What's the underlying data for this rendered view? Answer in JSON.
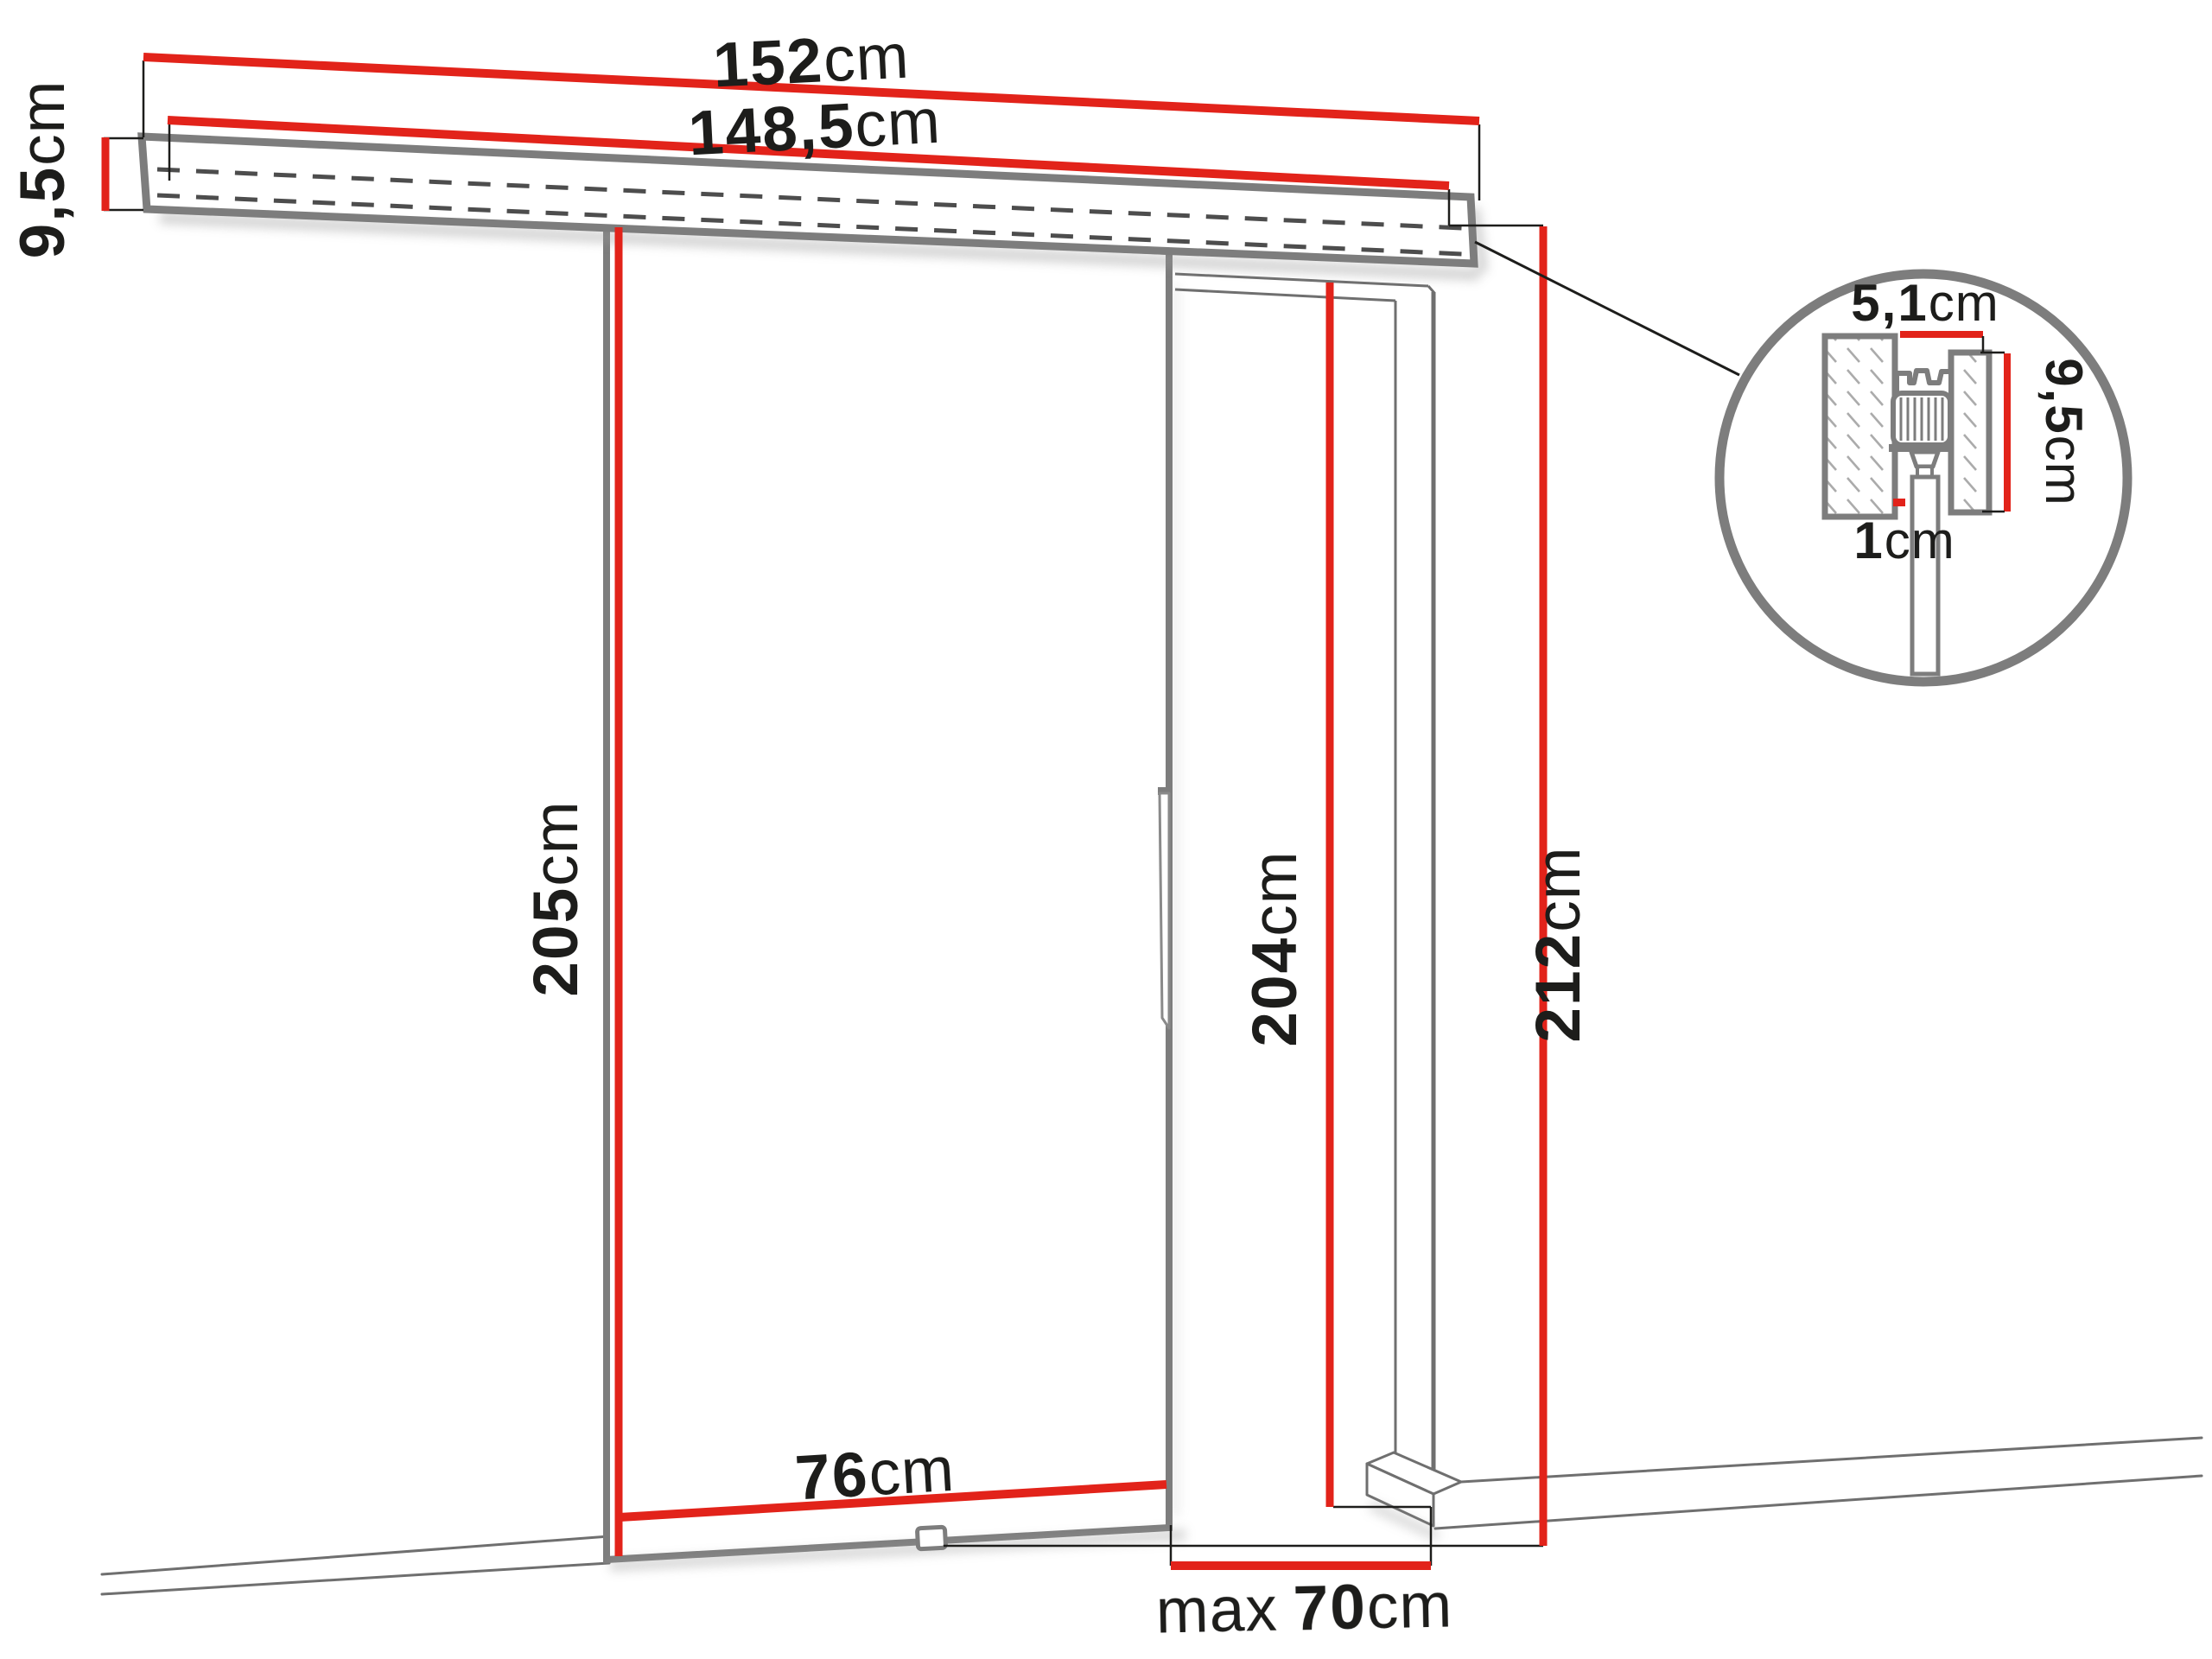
{
  "title": "Sliding door system dimension diagram",
  "colors": {
    "dimension_red": "#e2231a",
    "outline_gray": "#7d7d7d",
    "thin_line_gray": "#6f6f6f",
    "dash_gray": "#4d4d4d",
    "text_black": "#1d1d1b",
    "background": "#ffffff"
  },
  "labels": {
    "track_total": {
      "value": "152",
      "unit": "cm"
    },
    "track_effective": {
      "value": "148,5",
      "unit": "cm"
    },
    "track_height": {
      "value": "9,5",
      "unit": "cm"
    },
    "door_height": {
      "value": "205",
      "unit": "cm"
    },
    "opening_height": {
      "value": "204",
      "unit": "cm"
    },
    "overall_height": {
      "value": "212",
      "unit": "cm"
    },
    "door_width": {
      "value": "76",
      "unit": "cm"
    },
    "max_opening": {
      "prefix": "max",
      "value": "70",
      "unit": "cm"
    },
    "detail_track_width": {
      "value": "5,1",
      "unit": "cm"
    },
    "detail_track_height": {
      "value": "9,5",
      "unit": "cm"
    },
    "detail_wall_gap": {
      "value": "1",
      "unit": "cm"
    }
  }
}
